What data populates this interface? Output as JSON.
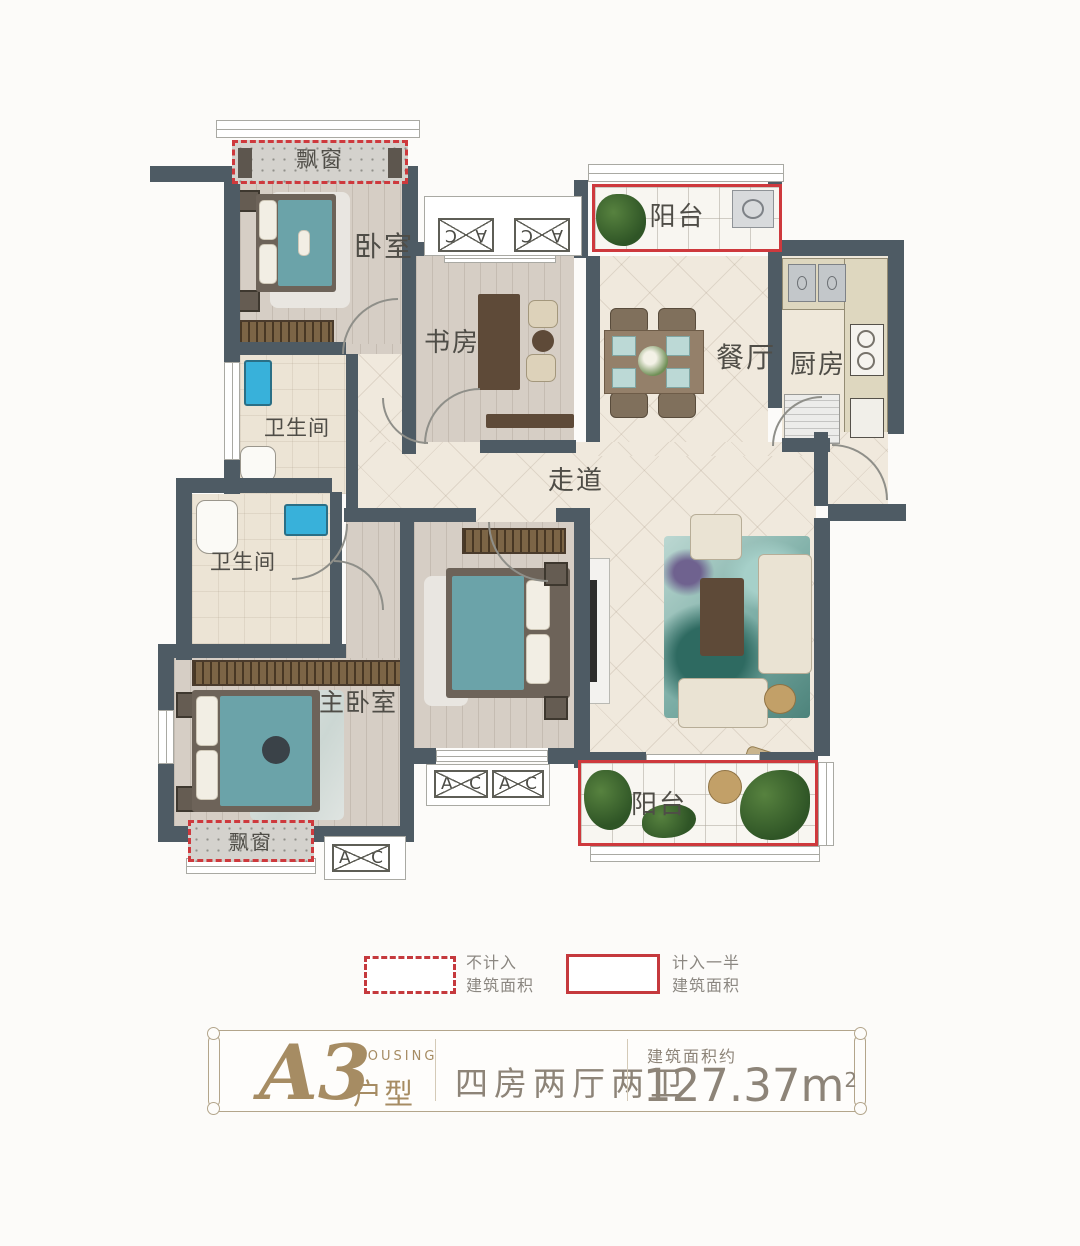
{
  "plan": {
    "rooms": {
      "bay_top": "飘窗",
      "bedroom": "卧室",
      "study": "书房",
      "balcony_top": "阳台",
      "dining": "餐厅",
      "kitchen": "厨房",
      "bath_upper": "卫生间",
      "bath_lower": "卫生间",
      "corridor": "走道",
      "master": "主卧室",
      "balcony_bottom": "阳台",
      "bay_bottom": "飘窗"
    },
    "ac": {
      "left": "A",
      "right": "C"
    }
  },
  "legend": {
    "excluded": {
      "line1": "不计入",
      "line2": "建筑面积"
    },
    "half": {
      "line1": "计入一半",
      "line2": "建筑面积"
    }
  },
  "footer": {
    "unit": "A3",
    "housing": "HOUSING",
    "type": "户型",
    "layout": "四房两厅两卫",
    "area_label": "建筑面积约",
    "area_value": "127.37",
    "area_unit": "m",
    "area_exp": "2"
  },
  "colors": {
    "red": "#ce393d",
    "wall": "#4e5b64",
    "teal_bed": "#6ba3a9",
    "tan": "#a68c63",
    "wood": "#d6cec5",
    "tile": "#f0e9dd"
  }
}
